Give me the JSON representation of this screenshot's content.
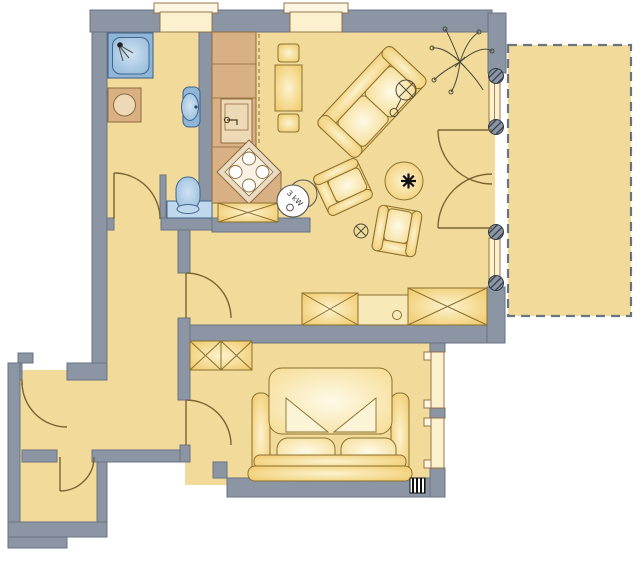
{
  "document": {
    "type": "apartment-floor-plan",
    "title": "Apartment floor plan"
  },
  "labels": {
    "boiler_power": "3 kW"
  },
  "colors": {
    "background": "#ffffff",
    "floor": "#F2DB9A",
    "wall": "#8C95A3",
    "wall_edge": "#6A7380",
    "furniture": "#EFC55F",
    "furniture_light": "#FCF3CF",
    "furniture_line": "#8A7030",
    "wood": "#D8B083",
    "wood_line": "#8F6B3C",
    "wood_light": "#EDD9B6",
    "blue": "#8FB6D9",
    "blue_light": "#CFE2F1",
    "blue_pale": "#BFD8EC",
    "blue_line": "#41658D",
    "door_swing": "#7A6434",
    "sketch": "#4A4A3A",
    "window_fill": "#FBF1CE",
    "sill": "#FDF6E3",
    "text": "#333333",
    "hatch_dark": "#2E3845"
  },
  "rooms": [
    {
      "name": "bathroom"
    },
    {
      "name": "kitchen"
    },
    {
      "name": "living-room"
    },
    {
      "name": "hall"
    },
    {
      "name": "bedroom"
    },
    {
      "name": "entrance-vestibule"
    },
    {
      "name": "storage"
    },
    {
      "name": "terrace"
    }
  ],
  "furniture": [
    "shower",
    "washing-machine",
    "washbasin",
    "toilet",
    "kitchen-counter",
    "kitchen-sink",
    "corner-stove",
    "boiler-3kw",
    "dining-table",
    "dining-chairs",
    "sofa",
    "armchair",
    "coffee-table",
    "floor-lamp",
    "plant",
    "floor-symbol",
    "sideboard",
    "dresser",
    "wardrobe",
    "double-bed",
    "pillows",
    "radiator"
  ]
}
